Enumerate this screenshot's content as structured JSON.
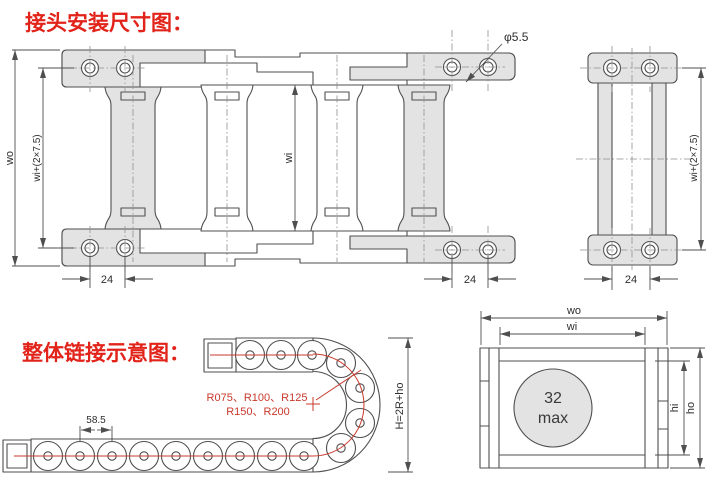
{
  "titles": {
    "installation_title": "接头安装尺寸图：",
    "assembly_title": "整体链接示意图："
  },
  "plan_view": {
    "hole_diameter": "φ5.5",
    "outer_width": "wo",
    "width_with_flange": "wi+(2×7.5)",
    "inner_width": "wi",
    "hole_pitch_left": "24",
    "hole_pitch_right": "24"
  },
  "end_view": {
    "width_with_flange": "wi+(2×7.5)",
    "hole_pitch": "24"
  },
  "chain_view": {
    "link_pitch": "58.5",
    "bend_radii_line1": "R075、R100、R125",
    "bend_radii_line2": "R150、R200",
    "height_formula": "H=2R+ho"
  },
  "section_view": {
    "outer_width": "wo",
    "inner_width": "wi",
    "capacity_value": "32",
    "capacity_unit": "max",
    "inner_height": "hi",
    "outer_height": "ho"
  },
  "colors": {
    "title_red": "#e2231a",
    "annotation_red": "#c9392b",
    "line_gray": "#4f4f4f",
    "fill_gray": "#e3e3e3"
  }
}
